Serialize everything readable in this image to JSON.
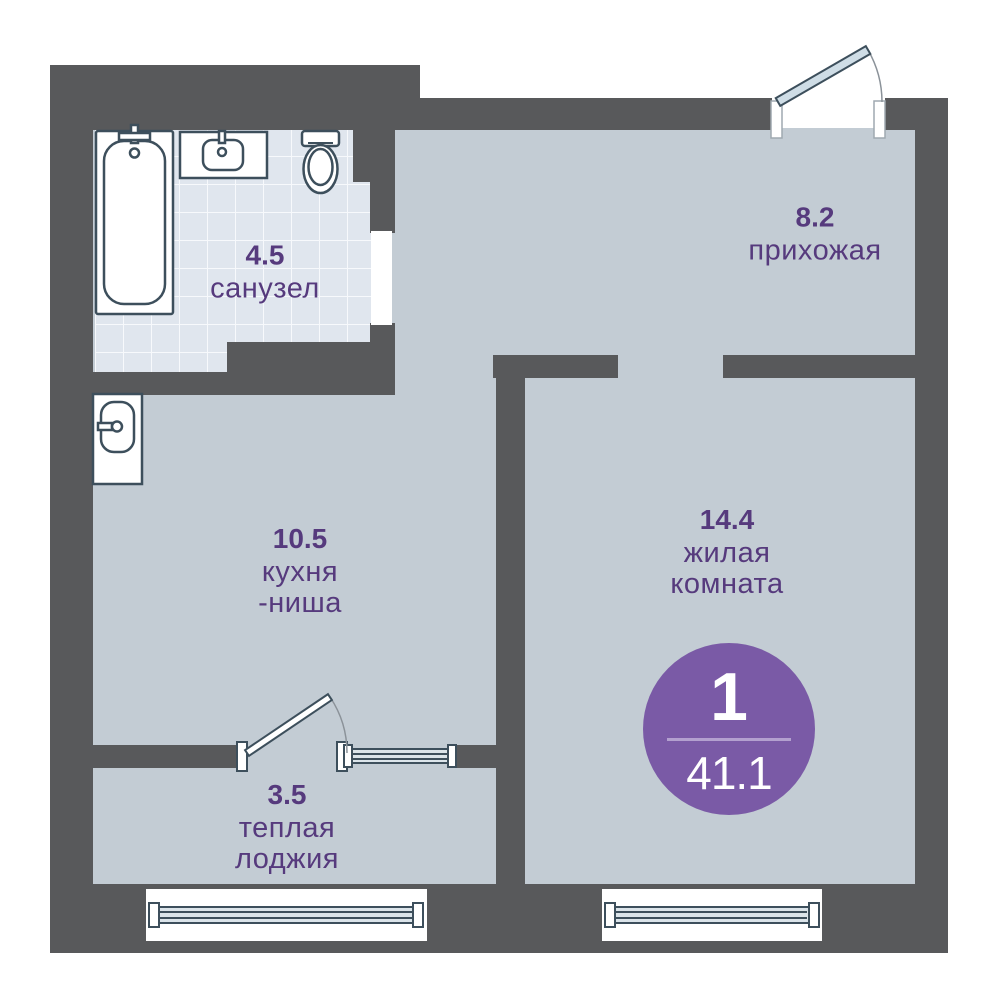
{
  "colors": {
    "wall": "#58595b",
    "floor": "#c3ccd4",
    "tile": "#e0e6ee",
    "tileline": "#f7f9fc",
    "accent": "#563a7d",
    "badge": "#7a5aa6",
    "fixture": "#3d4f5c",
    "leaf": "#cfdde6",
    "arc": "#8b9299"
  },
  "rooms": {
    "bathroom": {
      "area": "4.5",
      "name_line1": "санузел"
    },
    "hallway": {
      "area": "8.2",
      "name_line1": "прихожая"
    },
    "kitchen": {
      "area": "10.5",
      "name_line1": "кухня",
      "name_line2": "-ниша"
    },
    "living": {
      "area": "14.4",
      "name_line1": "жилая",
      "name_line2": "комната"
    },
    "loggia": {
      "area": "3.5",
      "name_line1": "теплая",
      "name_line2": "лоджия"
    }
  },
  "badge": {
    "rooms_count": "1",
    "total_area": "41.1"
  }
}
